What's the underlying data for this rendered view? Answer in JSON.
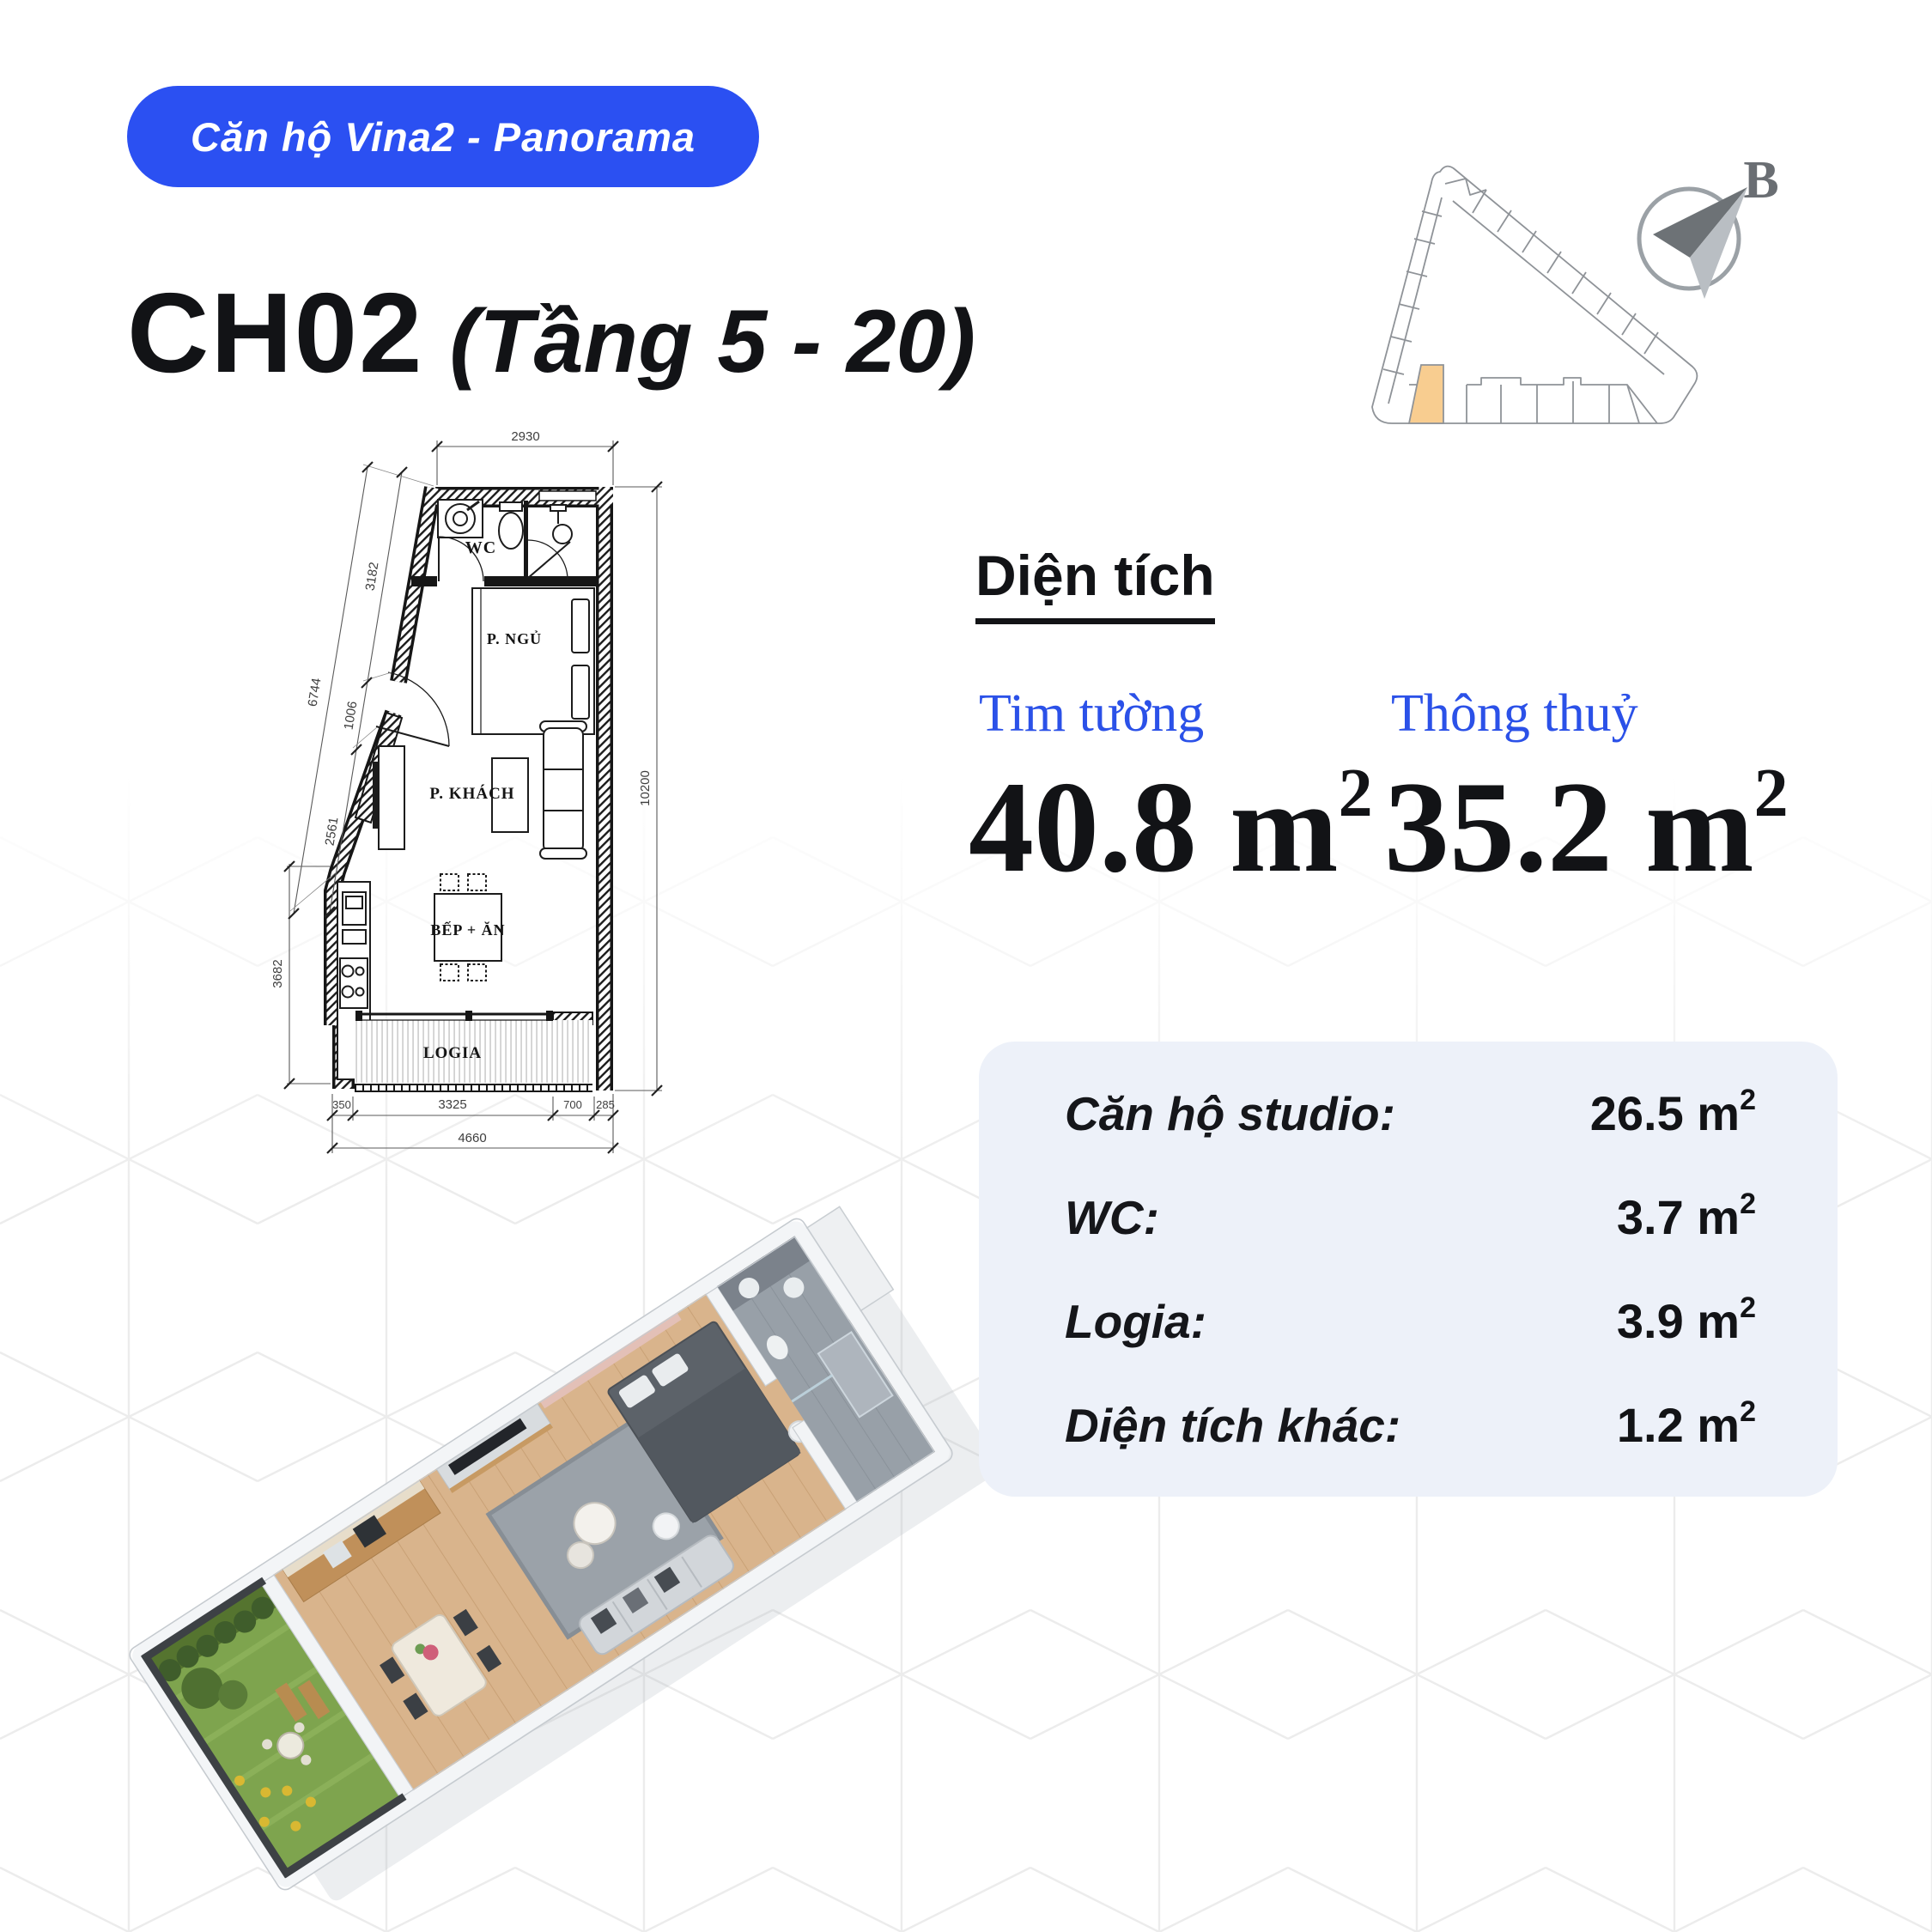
{
  "badge": {
    "label": "Căn hộ Vina2 - Panorama"
  },
  "title": {
    "unit": "CH02",
    "floors": "(Tầng 5 - 20)"
  },
  "key_plan": {
    "compass_label": "B"
  },
  "floor_plan": {
    "rooms": {
      "wc": "WC",
      "bedroom": "P. NGỦ",
      "living": "P. KHÁCH",
      "kitchen": "BẾP + ĂN",
      "logia": "LOGIA"
    },
    "dims": {
      "top": "2930",
      "left_total": "6744",
      "left_seg1": "3182",
      "left_seg2": "1006",
      "left_seg3": "2561",
      "left_vert": "3682",
      "right": "10200",
      "bottom_seg1": "350",
      "bottom_seg2": "3325",
      "bottom_seg3": "700",
      "bottom_seg4": "285",
      "bottom_total": "4660"
    }
  },
  "area_section": {
    "heading": "Diện tích",
    "columns": [
      {
        "label": "Tim tường",
        "value": "40.8 m",
        "sup": "2"
      },
      {
        "label": "Thông thuỷ",
        "value": "35.2 m",
        "sup": "2"
      }
    ]
  },
  "details_card": {
    "rows": [
      {
        "label": "Căn hộ studio:",
        "value": "26.5 m",
        "sup": "2"
      },
      {
        "label": "WC:",
        "value": "3.7 m",
        "sup": "2"
      },
      {
        "label": "Logia:",
        "value": "3.9 m",
        "sup": "2"
      },
      {
        "label": "Diện tích khác:",
        "value": "1.2 m",
        "sup": "2"
      }
    ]
  },
  "colors": {
    "badge_bg": "#2B50F2",
    "accent_blue": "#2B51E8",
    "card_bg": "#EDF1F9",
    "highlight_orange": "#F8CD90",
    "compass_gray": "#6A6E73"
  }
}
